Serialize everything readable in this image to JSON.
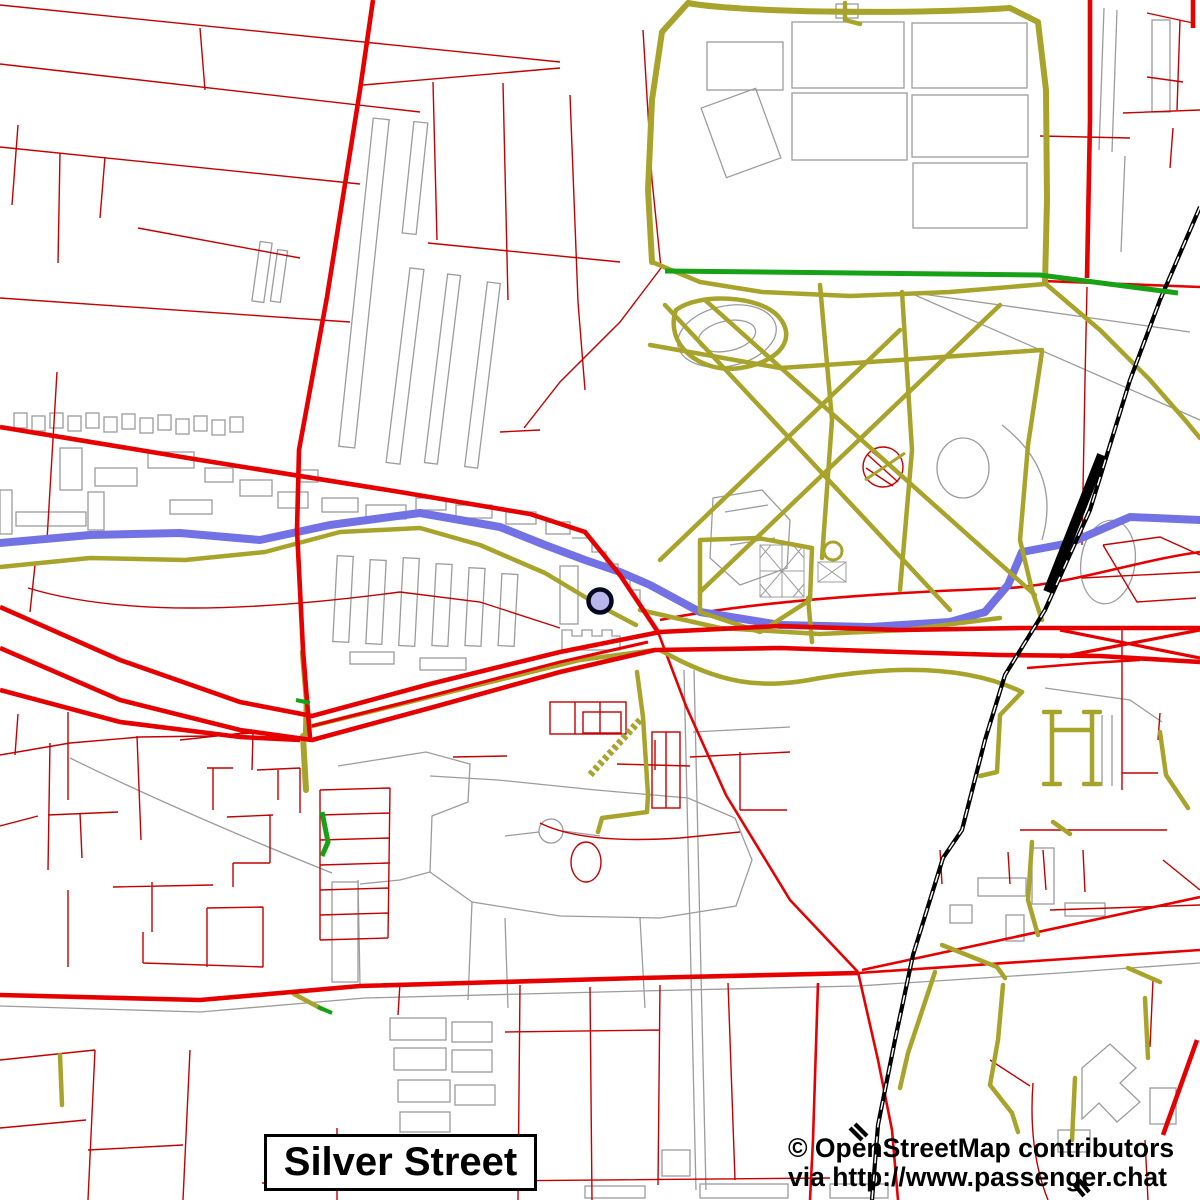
{
  "map": {
    "place_label": {
      "text": "Silver Street"
    },
    "attribution": {
      "line1": "© OpenStreetMap contributors",
      "line2": "via http://www.passenger.chat"
    },
    "marker": {
      "x": 600,
      "y": 601,
      "radius": 11.5,
      "fill": "#b7b7ec",
      "stroke": "#07071f",
      "ring_width": 4.5
    },
    "palette": {
      "background": "#ffffff",
      "road_major": "#e60000",
      "road_minor": "#c40000",
      "path_track": "#a8a42b",
      "greenway": "#17a117",
      "river": "#7272e4",
      "railway": "#000000",
      "building_outline": "#9c9c9c",
      "label_text": "#000000"
    }
  }
}
